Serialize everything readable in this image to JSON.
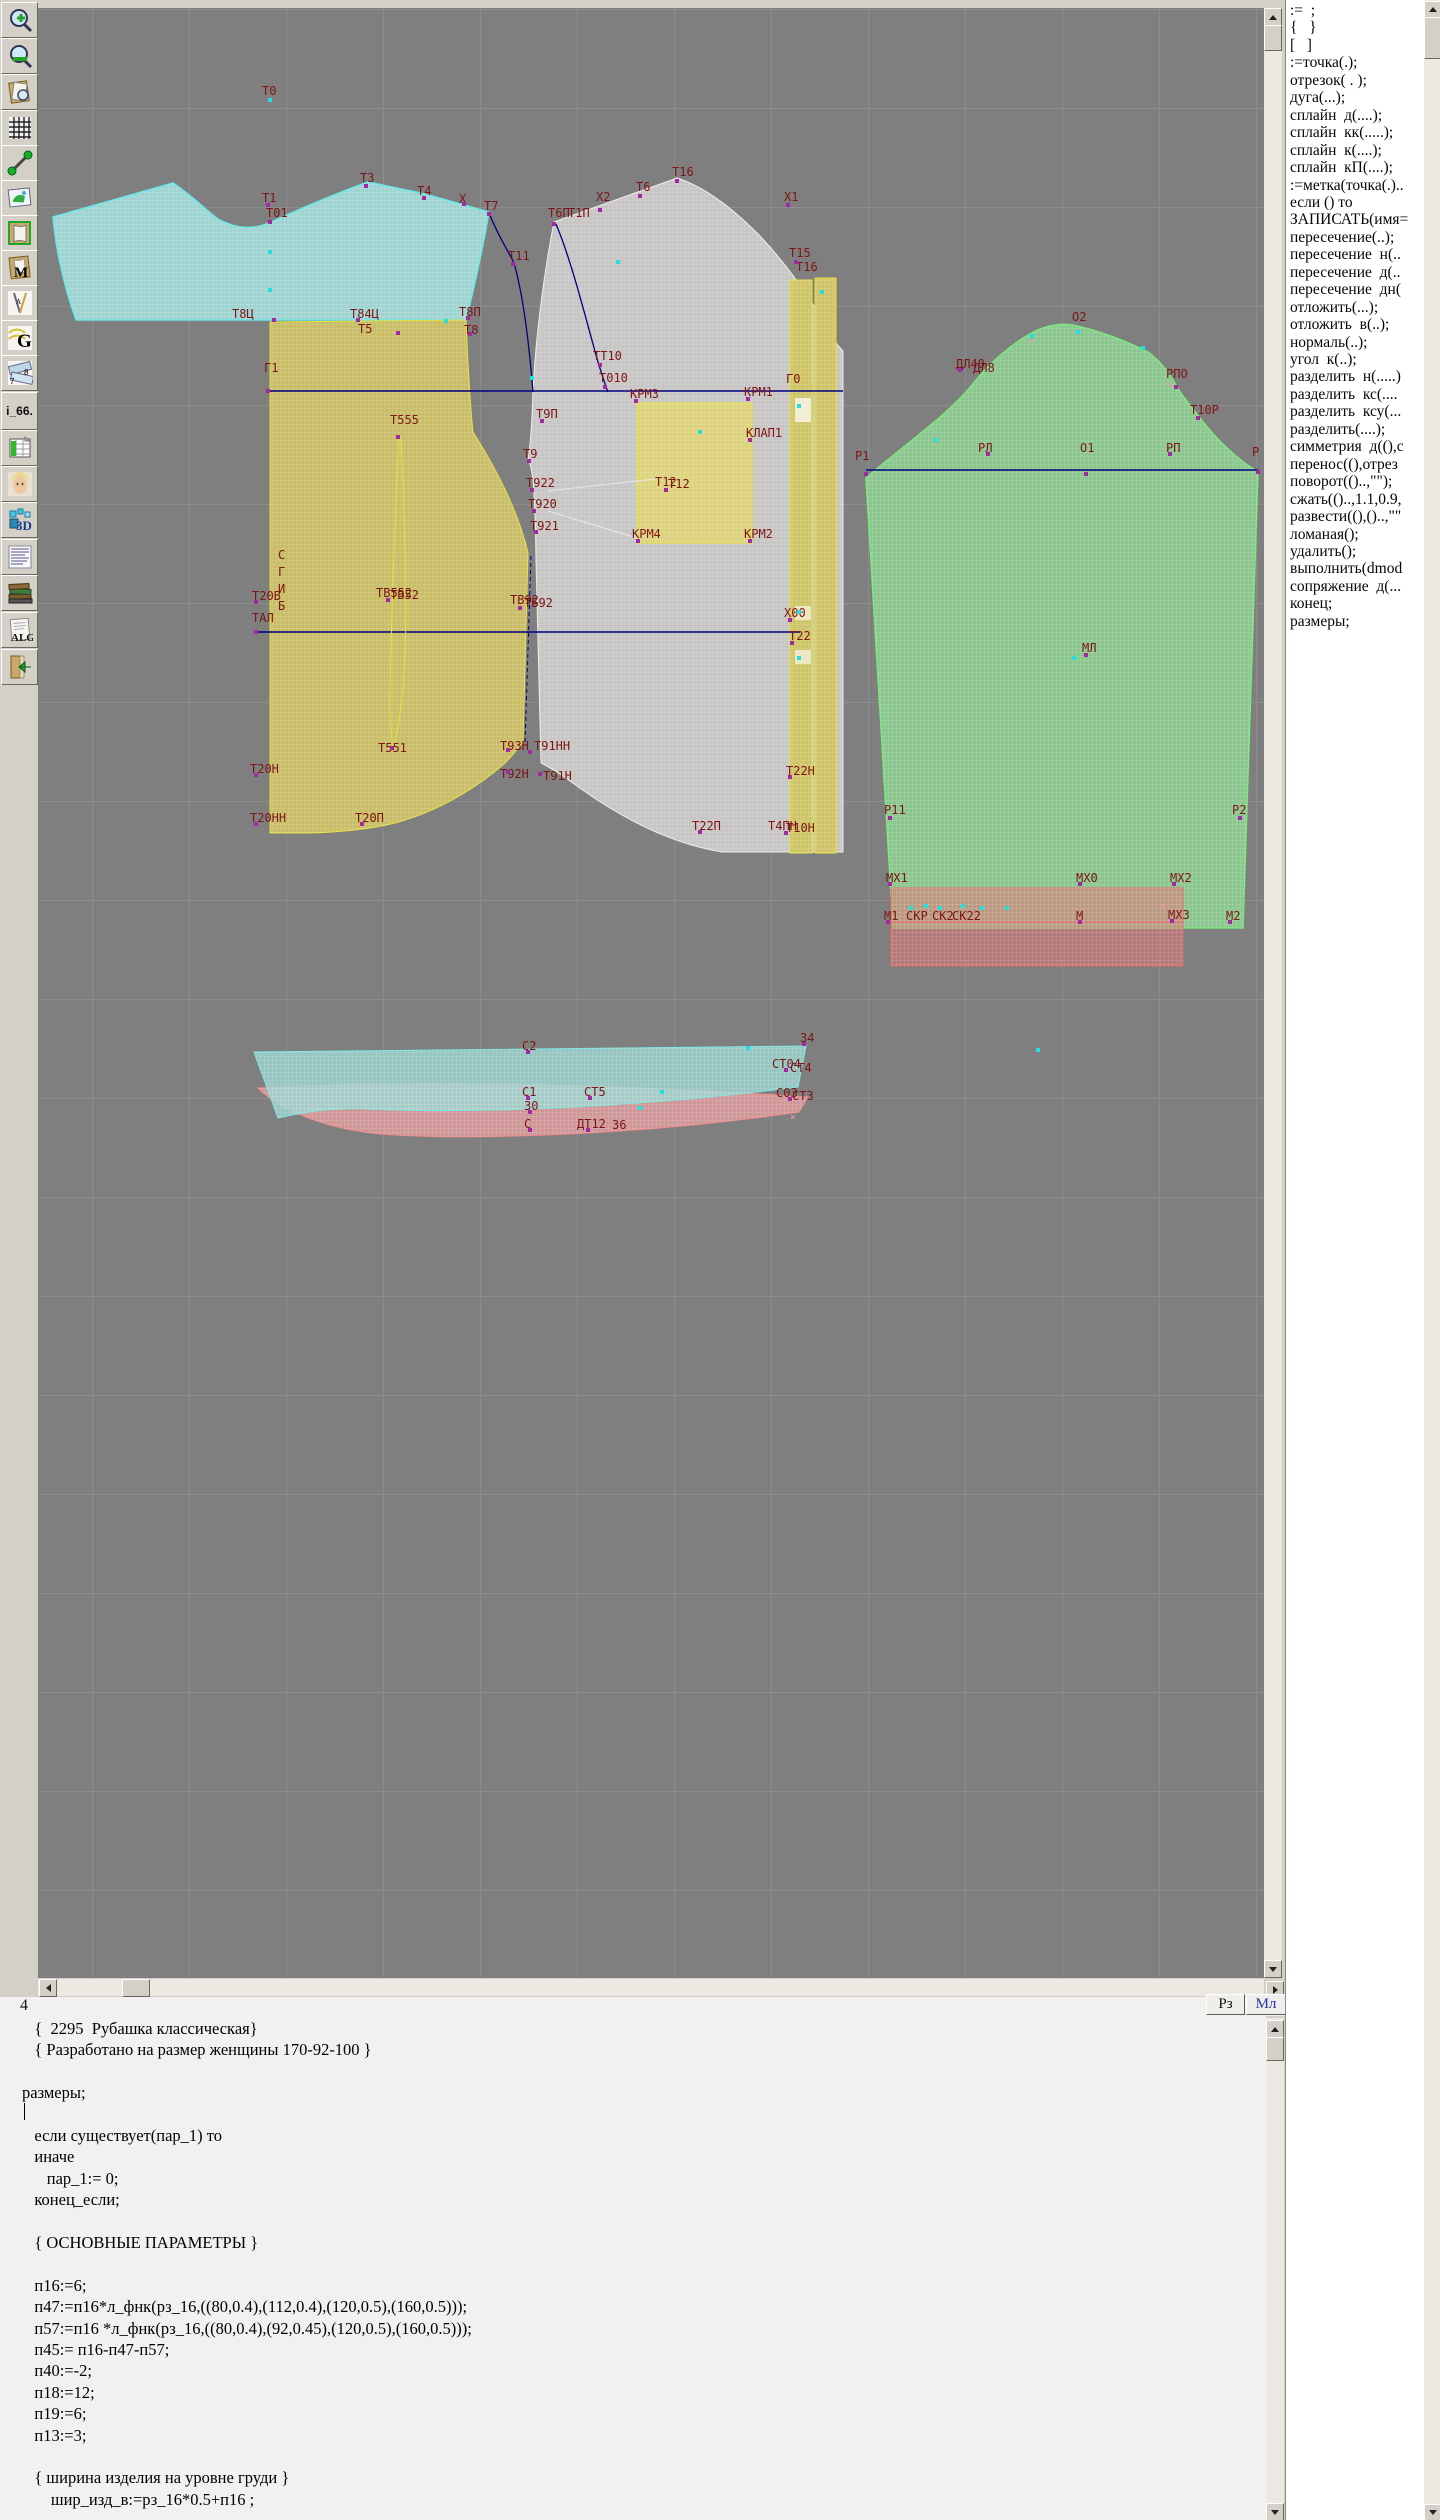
{
  "toolbar": {
    "icons": [
      "zoom-in",
      "zoom-out",
      "preview-sheet",
      "grid",
      "segment",
      "image",
      "pattern-outline",
      "pattern-m",
      "drafting-tools",
      "g-tool",
      "rulers",
      "i66-tool",
      "table-chart",
      "portrait",
      "3d-tool",
      "text-list",
      "books",
      "alg-doc",
      "exit-book"
    ],
    "text_labels": {
      "m": "M",
      "g": "G",
      "r7": "7",
      "r8": "8",
      "i66": "i_66.",
      "d3": "3D",
      "alg": "ALG"
    }
  },
  "statusbar": {
    "line_number": "4",
    "rz": "Рз",
    "ml": "Мл"
  },
  "commands": {
    "items": [
      ":=  ;",
      "{   }",
      "[   ]",
      ":=точка(.);",
      "отрезок( . );",
      "дуга(...);",
      "сплайн  д(....);",
      "сплайн  кк(.....);",
      "сплайн  к(....);",
      "сплайн  кП(....);",
      ":=метка(точка(.)..",
      "если () то",
      "ЗАПИСАТЬ(имя=",
      "пересечение(..);",
      "пересечение  н(..",
      "пересечение  д(..",
      "пересечение  дн(",
      "отложить(...);",
      "отложить  в(..);",
      "нормаль(..);",
      "угол  к(..);",
      "разделить  н(.....)",
      "разделить  кс(....",
      "разделить  ксу(...",
      "разделить(....);",
      "симметрия  д((),с",
      "перенос((),отрез",
      "поворот(()..,\"\");",
      "сжать(()..,1.1,0.9,",
      "развести((),()..,\"\"",
      "ломаная();",
      "удалить();",
      "выполнить(dmod",
      "сопряжение  д(...",
      "конец;",
      "размеры;"
    ]
  },
  "editor": {
    "lines": [
      "   {  2295  Рубашка классическая}",
      "   { Разработано на размер женщины 170-92-100 }",
      "",
      "размеры;",
      "",
      "   если существует(пар_1) то",
      "   иначе",
      "      пар_1:= 0;",
      "   конец_если;",
      "",
      "   { ОСНОВНЫЕ ПАРАМЕТРЫ }",
      "",
      "   п16:=6;",
      "   п47:=п16*л_фнк(рз_16,((80,0.4),(112,0.4),(120,0.5),(160,0.5)));",
      "   п57:=п16 *л_фнк(рз_16,((80,0.4),(92,0.45),(120,0.5),(160,0.5)));",
      "   п45:= п16-п47-п57;",
      "   п40:=-2;",
      "   п18:=12;",
      "   п19:=6;",
      "   п13:=3;",
      "",
      "   { ширина изделия на уровне груди }",
      "       шир_изд_в:=рз_16*0.5+п16 ;"
    ]
  },
  "canvas": {
    "fold_label": "СГИБ",
    "accent_colors": {
      "label": "#7e1414",
      "navy": "#000080",
      "yoke": "#9fd4d2",
      "front_left": "#c9bd67",
      "front_right": "#c7c6c4",
      "sleeve": "#8cc68f",
      "hem_band": "#e07474",
      "collar_cyan": "#9ed8d3",
      "collar_pink": "#dd9b9b"
    },
    "point_labels": [
      [
        "Т0",
        262,
        85
      ],
      [
        "Т1",
        262,
        192
      ],
      [
        "Т01",
        266,
        207
      ],
      [
        "Т3",
        360,
        172
      ],
      [
        "Т4",
        417,
        185
      ],
      [
        "Х",
        459,
        193
      ],
      [
        "Т7",
        484,
        200
      ],
      [
        "Т11",
        508,
        250
      ],
      [
        "Т8Ц",
        232,
        308
      ],
      [
        "Т84Ц",
        350,
        308
      ],
      [
        "Т5",
        358,
        323
      ],
      [
        "Т8П",
        459,
        306
      ],
      [
        "Т8",
        464,
        324
      ],
      [
        "Г1",
        264,
        362
      ],
      [
        "Т555",
        390,
        414
      ],
      [
        "Т16",
        672,
        166
      ],
      [
        "Т6",
        636,
        181
      ],
      [
        "Х2",
        596,
        191
      ],
      [
        "Т6П",
        548,
        207
      ],
      [
        "Т1П",
        568,
        207
      ],
      [
        "Х1",
        784,
        191
      ],
      [
        "Т15",
        789,
        247
      ],
      [
        "Т16",
        796,
        261
      ],
      [
        "ТТ10",
        593,
        350
      ],
      [
        "Т010",
        599,
        372
      ],
      [
        "КРМ3",
        630,
        388
      ],
      [
        "КРМ1",
        744,
        386
      ],
      [
        "Г0",
        786,
        373
      ],
      [
        "КЛАП1",
        746,
        427
      ],
      [
        "Т12",
        655,
        476
      ],
      [
        "Т12",
        668,
        478
      ],
      [
        "Т9П",
        536,
        408
      ],
      [
        "Т9",
        523,
        448
      ],
      [
        "Т922",
        526,
        477
      ],
      [
        "Т920",
        528,
        498
      ],
      [
        "Т921",
        530,
        520
      ],
      [
        "КРМ4",
        632,
        528
      ],
      [
        "КРМ2",
        744,
        528
      ],
      [
        "Т20В",
        252,
        590
      ],
      [
        "ТАЛ",
        252,
        612
      ],
      [
        "ТВ552",
        376,
        587
      ],
      [
        "ТВ52",
        390,
        589
      ],
      [
        "ТВ92",
        510,
        594
      ],
      [
        "ТБ92",
        524,
        597
      ],
      [
        "Х00",
        784,
        607
      ],
      [
        "Т22",
        789,
        630
      ],
      [
        "Т551",
        378,
        742
      ],
      [
        "Т93Н",
        500,
        740
      ],
      [
        "Т91НН",
        534,
        740
      ],
      [
        "Т92Н",
        500,
        768
      ],
      [
        "Т91Н",
        543,
        770
      ],
      [
        "Т20Н",
        250,
        763
      ],
      [
        "Т20НН",
        250,
        812
      ],
      [
        "Т20П",
        355,
        812
      ],
      [
        "Т22Н",
        786,
        765
      ],
      [
        "Т22П",
        692,
        820
      ],
      [
        "Т4ПН",
        768,
        820
      ],
      [
        "Т10Н",
        786,
        822
      ],
      [
        "О2",
        1072,
        311
      ],
      [
        "ДЛ40",
        956,
        358
      ],
      [
        "ДЛ8",
        973,
        362
      ],
      [
        "РПО",
        1166,
        368
      ],
      [
        "Т10Р",
        1190,
        404
      ],
      [
        "Р1",
        855,
        450
      ],
      [
        "РЛ",
        978,
        442
      ],
      [
        "О1",
        1080,
        442
      ],
      [
        "РП",
        1166,
        442
      ],
      [
        "Р",
        1252,
        446
      ],
      [
        "МЛ",
        1082,
        642
      ],
      [
        "Р11",
        884,
        804
      ],
      [
        "Р2",
        1232,
        804
      ],
      [
        "МХ1",
        886,
        872
      ],
      [
        "МХ0",
        1076,
        872
      ],
      [
        "МХ2",
        1170,
        872
      ],
      [
        "М1",
        884,
        910
      ],
      [
        "СКР",
        906,
        910
      ],
      [
        "СК2",
        932,
        910
      ],
      [
        "СК22",
        952,
        910
      ],
      [
        "М",
        1076,
        910
      ],
      [
        "МХ3",
        1168,
        909
      ],
      [
        "М2",
        1226,
        910
      ],
      [
        "С2",
        522,
        1040
      ],
      [
        "34",
        800,
        1032
      ],
      [
        "СТ04",
        772,
        1058
      ],
      [
        "СТ4",
        790,
        1062
      ],
      [
        "С1",
        522,
        1086
      ],
      [
        "30",
        524,
        1100
      ],
      [
        "СТ5",
        584,
        1086
      ],
      [
        "С03",
        776,
        1087
      ],
      [
        "СТ3",
        792,
        1090
      ],
      [
        "С",
        524,
        1118
      ],
      [
        "ДТ12",
        577,
        1118
      ],
      [
        "З6",
        612,
        1119
      ]
    ],
    "markers": [
      [
        266,
        203,
        "p"
      ],
      [
        268,
        220,
        "p"
      ],
      [
        364,
        184,
        "p"
      ],
      [
        422,
        196,
        "p"
      ],
      [
        462,
        202,
        "p"
      ],
      [
        487,
        212,
        "p"
      ],
      [
        511,
        262,
        "p"
      ],
      [
        272,
        318,
        "p"
      ],
      [
        356,
        318,
        "p"
      ],
      [
        396,
        331,
        "p"
      ],
      [
        466,
        316,
        "p"
      ],
      [
        468,
        332,
        "p"
      ],
      [
        266,
        389,
        "p"
      ],
      [
        396,
        435,
        "p"
      ],
      [
        552,
        222,
        "p"
      ],
      [
        598,
        208,
        "p"
      ],
      [
        638,
        194,
        "p"
      ],
      [
        675,
        179,
        "p"
      ],
      [
        786,
        203,
        "p"
      ],
      [
        794,
        260,
        "p"
      ],
      [
        598,
        363,
        "p"
      ],
      [
        603,
        385,
        "p"
      ],
      [
        634,
        399,
        "p"
      ],
      [
        746,
        397,
        "p"
      ],
      [
        748,
        438,
        "p"
      ],
      [
        664,
        488,
        "p"
      ],
      [
        540,
        419,
        "p"
      ],
      [
        527,
        459,
        "p"
      ],
      [
        530,
        488,
        "p"
      ],
      [
        532,
        509,
        "p"
      ],
      [
        534,
        530,
        "p"
      ],
      [
        636,
        539,
        "p"
      ],
      [
        748,
        539,
        "p"
      ],
      [
        254,
        600,
        "p"
      ],
      [
        254,
        630,
        "p"
      ],
      [
        386,
        598,
        "p"
      ],
      [
        518,
        606,
        "p"
      ],
      [
        788,
        618,
        "p"
      ],
      [
        790,
        641,
        "p"
      ],
      [
        390,
        746,
        "p"
      ],
      [
        506,
        748,
        "p"
      ],
      [
        528,
        750,
        "p"
      ],
      [
        506,
        770,
        "p"
      ],
      [
        538,
        772,
        "p"
      ],
      [
        254,
        773,
        "p"
      ],
      [
        254,
        822,
        "p"
      ],
      [
        360,
        822,
        "p"
      ],
      [
        788,
        775,
        "p"
      ],
      [
        698,
        830,
        "p"
      ],
      [
        784,
        831,
        "p"
      ],
      [
        958,
        368,
        "p"
      ],
      [
        1174,
        385,
        "p"
      ],
      [
        1196,
        416,
        "p"
      ],
      [
        864,
        472,
        "p"
      ],
      [
        986,
        452,
        "p"
      ],
      [
        1084,
        472,
        "p"
      ],
      [
        1168,
        452,
        "p"
      ],
      [
        1256,
        470,
        "p"
      ],
      [
        1084,
        653,
        "p"
      ],
      [
        888,
        816,
        "p"
      ],
      [
        1238,
        816,
        "p"
      ],
      [
        888,
        882,
        "p"
      ],
      [
        1078,
        882,
        "p"
      ],
      [
        1172,
        882,
        "p"
      ],
      [
        886,
        920,
        "p"
      ],
      [
        1078,
        920,
        "p"
      ],
      [
        1170,
        919,
        "p"
      ],
      [
        1228,
        920,
        "p"
      ],
      [
        526,
        1050,
        "p"
      ],
      [
        802,
        1042,
        "p"
      ],
      [
        784,
        1068,
        "p"
      ],
      [
        526,
        1096,
        "p"
      ],
      [
        528,
        1110,
        "p"
      ],
      [
        588,
        1096,
        "p"
      ],
      [
        788,
        1097,
        "p"
      ],
      [
        528,
        1128,
        "p"
      ],
      [
        586,
        1128,
        "p"
      ],
      [
        268,
        98,
        "c"
      ],
      [
        268,
        250,
        "c"
      ],
      [
        268,
        288,
        "c"
      ],
      [
        444,
        319,
        "c"
      ],
      [
        530,
        376,
        "c"
      ],
      [
        616,
        260,
        "c"
      ],
      [
        698,
        430,
        "c"
      ],
      [
        820,
        290,
        "c"
      ],
      [
        797,
        404,
        "c"
      ],
      [
        797,
        610,
        "c"
      ],
      [
        797,
        656,
        "c"
      ],
      [
        1030,
        334,
        "c"
      ],
      [
        1076,
        330,
        "c"
      ],
      [
        1141,
        346,
        "c"
      ],
      [
        933,
        438,
        "c"
      ],
      [
        1072,
        656,
        "c"
      ],
      [
        909,
        906,
        "c"
      ],
      [
        924,
        904,
        "c"
      ],
      [
        938,
        906,
        "c"
      ],
      [
        961,
        904,
        "c"
      ],
      [
        980,
        906,
        "c"
      ],
      [
        1005,
        906,
        "c"
      ],
      [
        746,
        1046,
        "c"
      ],
      [
        638,
        1106,
        "c"
      ],
      [
        1036,
        1048,
        "c"
      ],
      [
        660,
        1090,
        "c"
      ],
      [
        1160,
        901,
        "x"
      ],
      [
        790,
        1112,
        "x"
      ],
      [
        1028,
        336,
        "x"
      ],
      [
        1166,
        380,
        "x"
      ]
    ]
  }
}
